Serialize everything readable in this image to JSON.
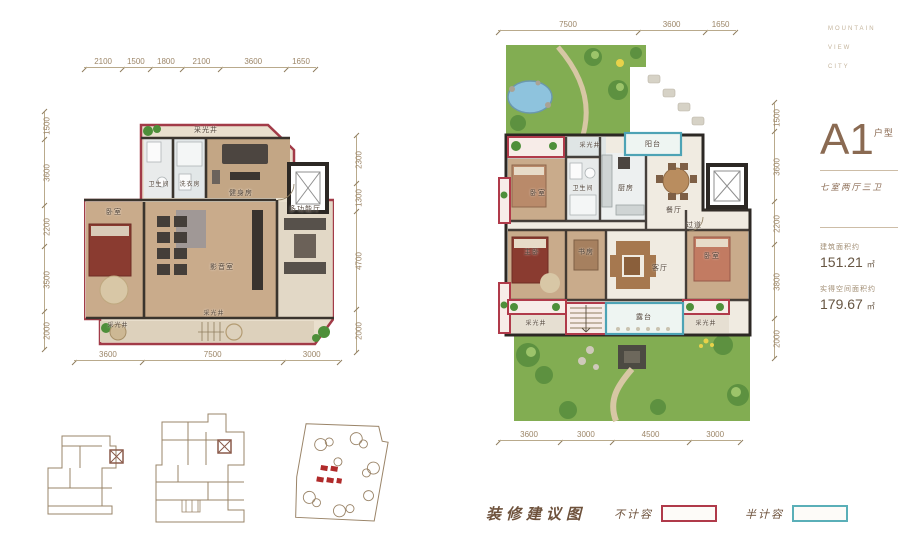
{
  "brand": {
    "line1": "MOUNTAIN",
    "line2": "VIEW",
    "line3": "CITY"
  },
  "unit": {
    "name": "A1",
    "suffix": "户型",
    "tagline": "七室两厅三卫",
    "area1_label": "建筑面积约",
    "area1_value": "151.21",
    "area2_label": "实得空间面积约",
    "area2_value": "179.67",
    "area_unit": "㎡"
  },
  "legend": {
    "title": "装修建议图",
    "item1": "不计容",
    "item2": "半计容"
  },
  "colors": {
    "accent_red": "#b03a4a",
    "accent_teal": "#5aafb8",
    "brand_tan": "#8a6a52",
    "garden_green": "#82ad52"
  },
  "plan_left": {
    "dims_top": [
      "2100",
      "1500",
      "1800",
      "2100",
      "3600",
      "1650"
    ],
    "dims_left": [
      "1500",
      "3600",
      "2200",
      "3500",
      "2000"
    ],
    "dims_right": [
      "2300",
      "1300",
      "4700",
      "2000"
    ],
    "dims_bottom": [
      "3600",
      "7500",
      "3000"
    ],
    "rooms": {
      "lightwell_top": "采光井",
      "bath": "卫生间",
      "laundry": "洗衣房",
      "gym": "健身房",
      "multi_hall": "多功能厅",
      "bedroom": "卧室",
      "theater": "影音室",
      "lightwell_bl": "采光井",
      "lightwell_bc": "采光井"
    }
  },
  "plan_right": {
    "dims_top": [
      "7500",
      "3600",
      "1650"
    ],
    "dims_right": [
      "1500",
      "3600",
      "2200",
      "3800",
      "2000"
    ],
    "dims_bottom": [
      "3600",
      "3000",
      "4500",
      "3000"
    ],
    "rooms": {
      "lightwell_top": "采光井",
      "balcony_top": "阳台",
      "bedroom_top": "卧室",
      "bath": "卫生间",
      "kitchen": "厨房",
      "dining": "餐厅",
      "hallway": "过道",
      "master": "主卧",
      "study": "书房",
      "living": "客厅",
      "bedroom_br": "卧室",
      "lightwell_bl": "采光井",
      "terrace": "露台",
      "lightwell_br": "采光井"
    }
  }
}
